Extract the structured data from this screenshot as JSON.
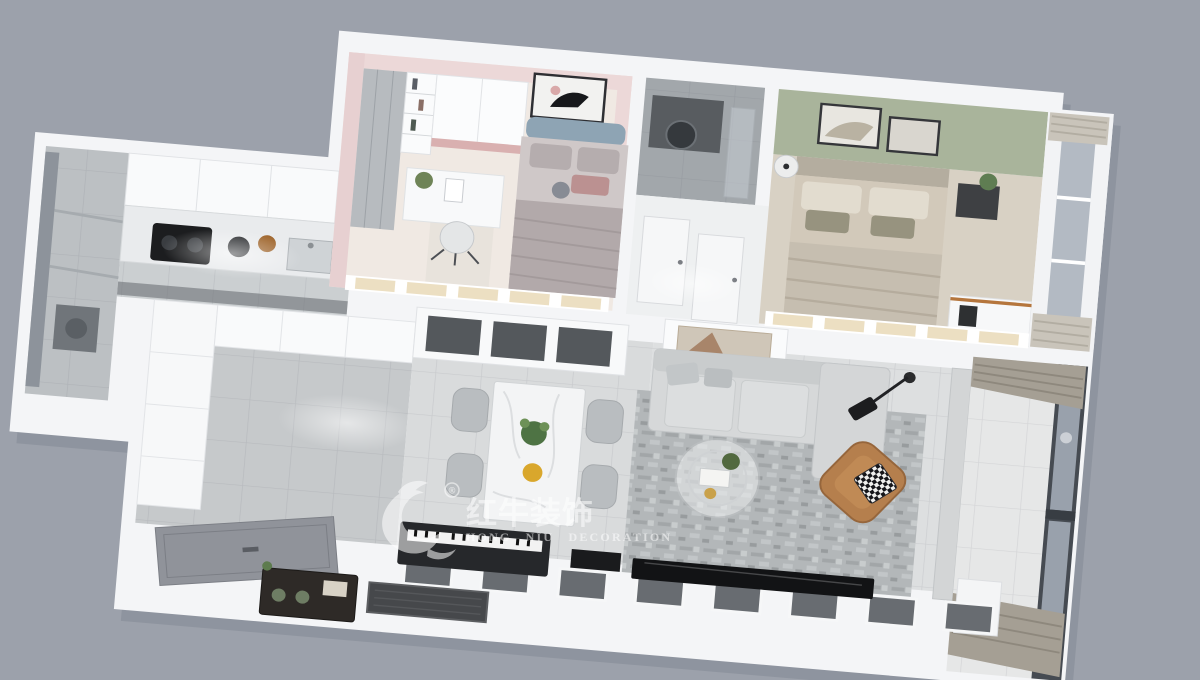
{
  "watermark": {
    "logo": "bull-swoosh-icon",
    "registered_symbol": "®",
    "brand_cn": "红牛装饰",
    "brand_en": "HONG NIU DECORATION"
  },
  "palette": {
    "background": "#9ca1ab",
    "walls": "#f4f5f7",
    "wall_shadow": "#7e8490",
    "pink_wall": "#ecd8d8",
    "sage_wall": "#a9b49b",
    "headboard_blue": "#8ea4b4",
    "leather_armchair": "#b57f4d",
    "rug_gray": "#b3b7b9",
    "curtain_taupe": "#a59f94",
    "window_glass": "#99a1ac",
    "tv_black": "#121315",
    "tile_gray": "#c6c9cb",
    "beige_pane": "#ecdfc2"
  },
  "scene": {
    "style": "3D cutaway top-view apartment rendering",
    "rooms": [
      {
        "name": "kids-bedroom",
        "accent": "pink walls",
        "items": [
          "double bed with blue-gray headboard",
          "gray bedding and pillows",
          "framed wall artwork",
          "white wardrobe",
          "bookshelf",
          "mirrored closet",
          "study desk with chair",
          "plush toy",
          "beige window seat band"
        ]
      },
      {
        "name": "bathroom",
        "items": [
          "gray wall tiles",
          "dark vanity",
          "round mirror",
          "glass shower partition"
        ]
      },
      {
        "name": "hallway",
        "items": [
          "two white interior doors"
        ]
      },
      {
        "name": "master-bedroom",
        "accent": "sage green accent wall",
        "items": [
          "double bed with beige bedding",
          "two framed pictures on accent wall",
          "black nightstand with plant",
          "round side table",
          "desk with wood wall shelf and speaker",
          "window with bunched sheer curtains"
        ]
      },
      {
        "name": "laundry-balcony",
        "items": [
          "full-height window",
          "storage shelving",
          "dark appliance"
        ]
      },
      {
        "name": "kitchen",
        "items": [
          "white upper cabinets",
          "gray countertop",
          "black cooktop",
          "kettle",
          "bowl",
          "sink"
        ]
      },
      {
        "name": "entry-foyer",
        "items": [
          "floor-to-ceiling white cabinet wall",
          "white cabinet run",
          "gray tile floor"
        ]
      },
      {
        "name": "dining-area",
        "items": [
          "white marble dining table",
          "four gray chairs",
          "green potted plant",
          "fruit plate",
          "sideboard with smoked glass doors"
        ]
      },
      {
        "name": "living-room",
        "items": [
          "gray fabric sofa with chaise",
          "mottled gray rug",
          "round glass coffee table with books",
          "caramel leather armchair",
          "houndstooth cushion",
          "black arc floor lamp",
          "white media console with abstract mirror art",
          "wall TV on south wall",
          "stone partition column"
        ]
      },
      {
        "name": "balcony",
        "items": [
          "floor-to-ceiling dark framed window",
          "gray curtains bunched at both ends",
          "light tile floor"
        ]
      },
      {
        "name": "entrance-platform",
        "items": [
          "leaning entry door panel",
          "vintage radio console",
          "dark doormat",
          "electric piano on wall ledge",
          "row of dark wall inset panels"
        ]
      }
    ]
  }
}
